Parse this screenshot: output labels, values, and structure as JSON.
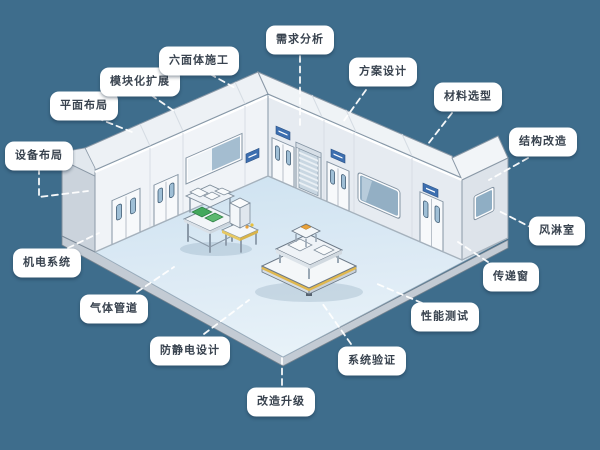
{
  "diagram": {
    "subject": "洁净室改造流程示意图",
    "callouts": [
      {
        "id": "requirement-analysis",
        "text": "需求分析"
      },
      {
        "id": "solution-design",
        "text": "方案设计"
      },
      {
        "id": "material-selection",
        "text": "材料选型"
      },
      {
        "id": "structural-modification",
        "text": "结构改造"
      },
      {
        "id": "air-shower",
        "text": "风淋室"
      },
      {
        "id": "pass-box",
        "text": "传递窗"
      },
      {
        "id": "performance-test",
        "text": "性能测试"
      },
      {
        "id": "system-validation",
        "text": "系统验证"
      },
      {
        "id": "renovation-upgrade",
        "text": "改造升级"
      },
      {
        "id": "anti-static-design",
        "text": "防静电设计"
      },
      {
        "id": "gas-piping",
        "text": "气体管道"
      },
      {
        "id": "mep-systems",
        "text": "机电系统"
      },
      {
        "id": "equipment-layout",
        "text": "设备布局"
      },
      {
        "id": "floor-plan",
        "text": "平面布局"
      },
      {
        "id": "modular-expansion",
        "text": "模块化扩展"
      },
      {
        "id": "hexahedral-construction",
        "text": "六面体施工"
      }
    ],
    "colors": {
      "background": "#3E6D8C",
      "floor": "#D8E8F3",
      "wall": "#F0F3F7",
      "wall_shaded": "#E6EBF1",
      "end_wall": "#CBD3DC",
      "roof": "#EDF1F5",
      "sign_blue": "#3D6FB0",
      "glass_blue": "#9DB9CE",
      "equipment_green": "#46A95D",
      "platform_trim_yellow": "#DDB54E",
      "label_background": "#FFFFFF",
      "label_text": "#39434F",
      "leader_line": "#FFFFFF"
    }
  }
}
